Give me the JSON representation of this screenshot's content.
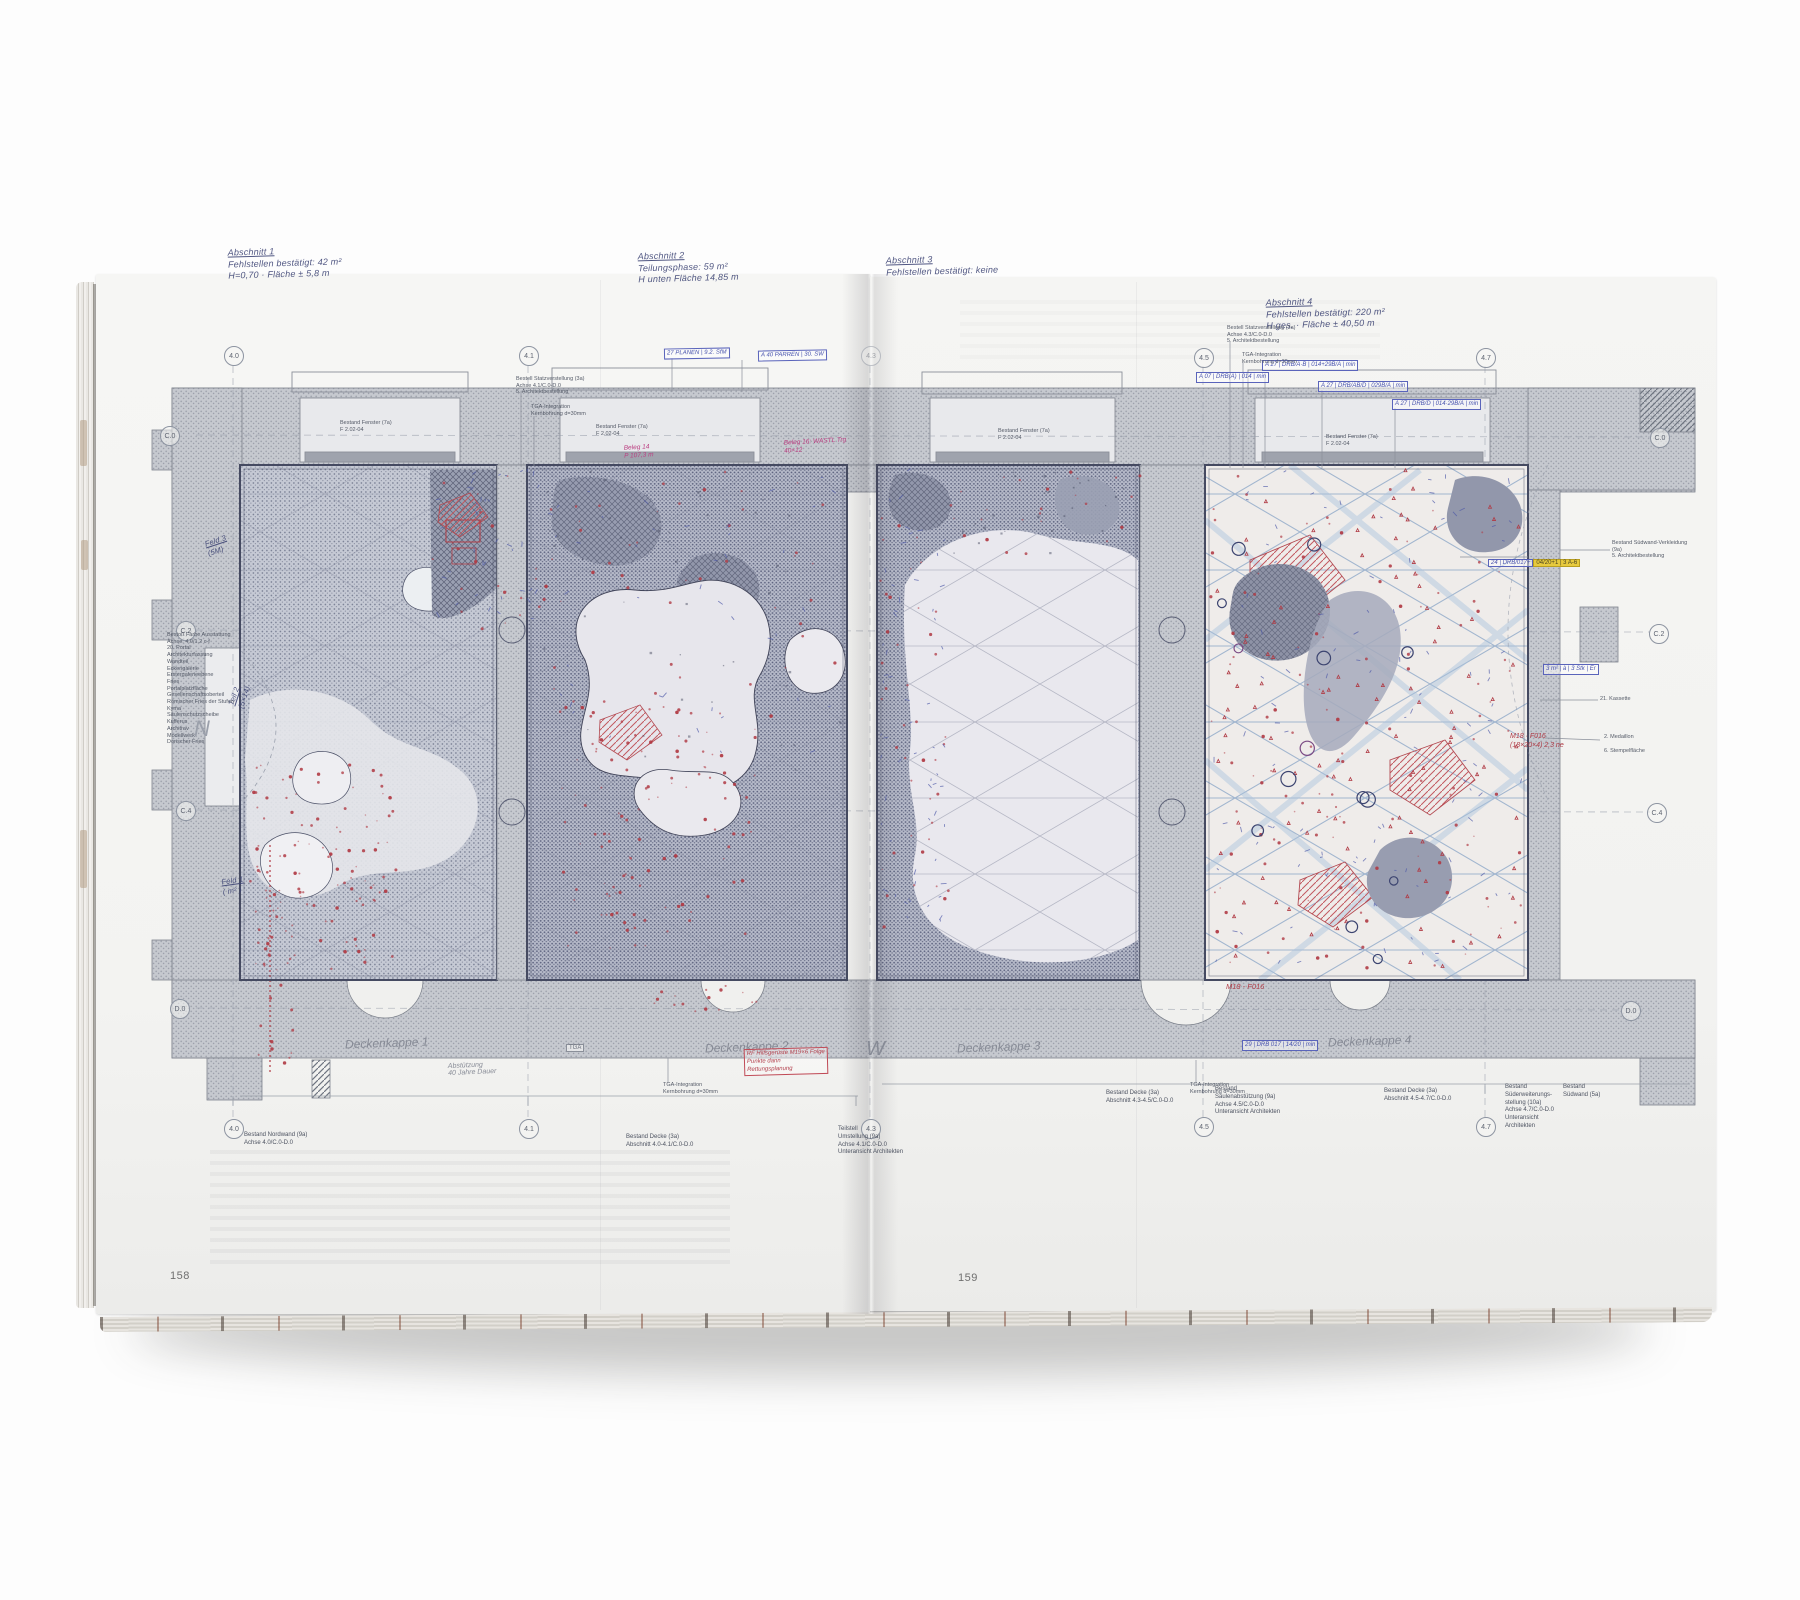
{
  "book": {
    "left_page_number": "158",
    "right_page_number": "159"
  },
  "axis_markers": {
    "top": [
      "4.0",
      "4.1",
      "4.3",
      "4.5",
      "4.7"
    ],
    "bottom": [
      "4.0",
      "4.1",
      "4.3",
      "4.5",
      "4.7"
    ],
    "left": [
      "C.0",
      "C.2",
      "C.4",
      "D.0"
    ],
    "right": [
      "C.0",
      "C.2",
      "C.4",
      "D.0"
    ]
  },
  "handwritten": {
    "note_1": "Abschnitt 1\nFehlstellen bestätigt: 42 m²\nH=0,70 · Fläche ± 5,8 m",
    "note_2": "Abschnitt 2\nTeilungsphase: 59 m²\nH unten Fläche 14,85 m",
    "note_3": "Abschnitt 3\nFehlstellen bestätigt: keine",
    "note_4": "Abschnitt 4\nFehlstellen bestätigt: 220 m²\nH ges. · Fläche ± 40,50 m",
    "deckenkappe_1": "Deckenkappe 1",
    "deckenkappe_2": "Deckenkappe 2",
    "deckenkappe_3": "Deckenkappe 3",
    "deckenkappe_4": "Deckenkappe 4",
    "north_letter": "N",
    "west_letter": "W",
    "feld_note_top": "Feld 3\n(5M)",
    "teil_note": "Teil 2\n(5×14)",
    "feld_note_bottom": "Feld 1\n( m² )",
    "pencil_note": "Abstützung\n40 Jahre Dauer",
    "red_note_box": "RF Hilfsgerüste M19×6 Folge\nPunkte dann\nRettungsplanung",
    "red_note_right": "M18 · F016\n(18×20×4) 2,3 ne",
    "red_note_p4": "M18 - F016",
    "magenta_note_1": "Beleg 14\nP 107,3 m",
    "magenta_note_2": "Beleg 16: WASTL Trg\n40×12"
  },
  "boxed_labels": {
    "blue_top_left_1": "27 PLANEN | 9.2. SfM",
    "blue_top_left_2": "A 40 PARREN | 30. SW",
    "blue_chain_1": "A 07 | DRB(A) | 014 | min",
    "blue_chain_2": "A 27 | DRB/A·B | 014+29B/A | min",
    "blue_chain_3": "A 27 | DRB/AB/D | 029B/A | min",
    "blue_chain_4": "A 27 | DRB/D | 014·29B/A | min",
    "blue_chain_bottom": "29 | DRB 017 | 14/20 | min",
    "blue_right_mid": "3 m² | à | 3 Stk | Er",
    "yellow_prefix": "24 | DRB/017+",
    "yellow_highlight": "04/20+1 | 3 A-6",
    "tga_box": "TGA"
  },
  "printed": {
    "legend_block": "Bestoß Farbe Ausstattung\nAchse: 4.0/1.2 c-f\n20. Portal\nArchitekturfassung\nWandteil\nEckengalerie\nErstergalerieebene\nFries\nPortalplatzfläche\nGesellenschaftsoberteil\nRömischer Fries der Stufen\nKyma\nSäulenschutzscheibe\nKufferus\nArchitrav\nModellwerk\nDorischer Fries",
    "window_label": "Bestand Fenster (7a)\nF 2.02-04",
    "stat_label_left": "Bestell Statzverstellung (3a)\nAchse 4.1/C.0-D.0\n5. Architektbestellung",
    "stat_label_right": "Bestell Statzverstellung (3a)\nAchse 4.3/C.0-D.0\n5. Architektbestellung",
    "tga_label": "TGA-Integration\nKernbohrung d=30mm",
    "wall_label_right": "Bestand Südwand-Verkleidung (9a)\n5. Architektbestellung",
    "right_margin_1": "21. Kassette",
    "right_margin_2": "2. Medaillon",
    "right_margin_3": "6. Stempelfläche",
    "caption_nordwand": "Bestand Nordwand (9a)\nAchse 4.0/C.0-D.0",
    "caption_decke_1": "Bestand Decke (3a)\nAbschnitt 4.0-4.1/C.0-D.0",
    "caption_teilstell": "Teilstell\nUmstellung (9a)\nAchse 4.1/C.0-D.0\nUnteransicht Architekten",
    "caption_decke_2": "Bestand Decke (3a)\nAbschnitt 4.3-4.5/C.0-D.0",
    "caption_saeule": "Bestand\nSäulenabstützung (9a)\nAchse 4.5/C.0-D.0\nUnteransicht Architekten",
    "caption_decke_3": "Bestand Decke (3a)\nAbschnitt 4.5-4.7/C.0-D.0",
    "caption_sued_erw": "Bestand\nSüderweiterungs-\nstellung (10a)\nAchse 4.7/C.0-D.0\nUnteransicht\nArchitekten",
    "caption_suedwand": "Bestand\nSüdwand (5a)"
  },
  "colors": {
    "background": "#fdfdfd",
    "page": "#f4f4f2",
    "wall_fill": "#c6c9cf",
    "panel_dark": "#b9bdcc",
    "ink_blue": "#4853ae",
    "ink_red": "#b23b44",
    "ink_magenta": "#bb3d80",
    "pencil_gray": "#878b96",
    "highlight_yellow": "#e7ca3e",
    "print_gray": "#4c5260"
  }
}
